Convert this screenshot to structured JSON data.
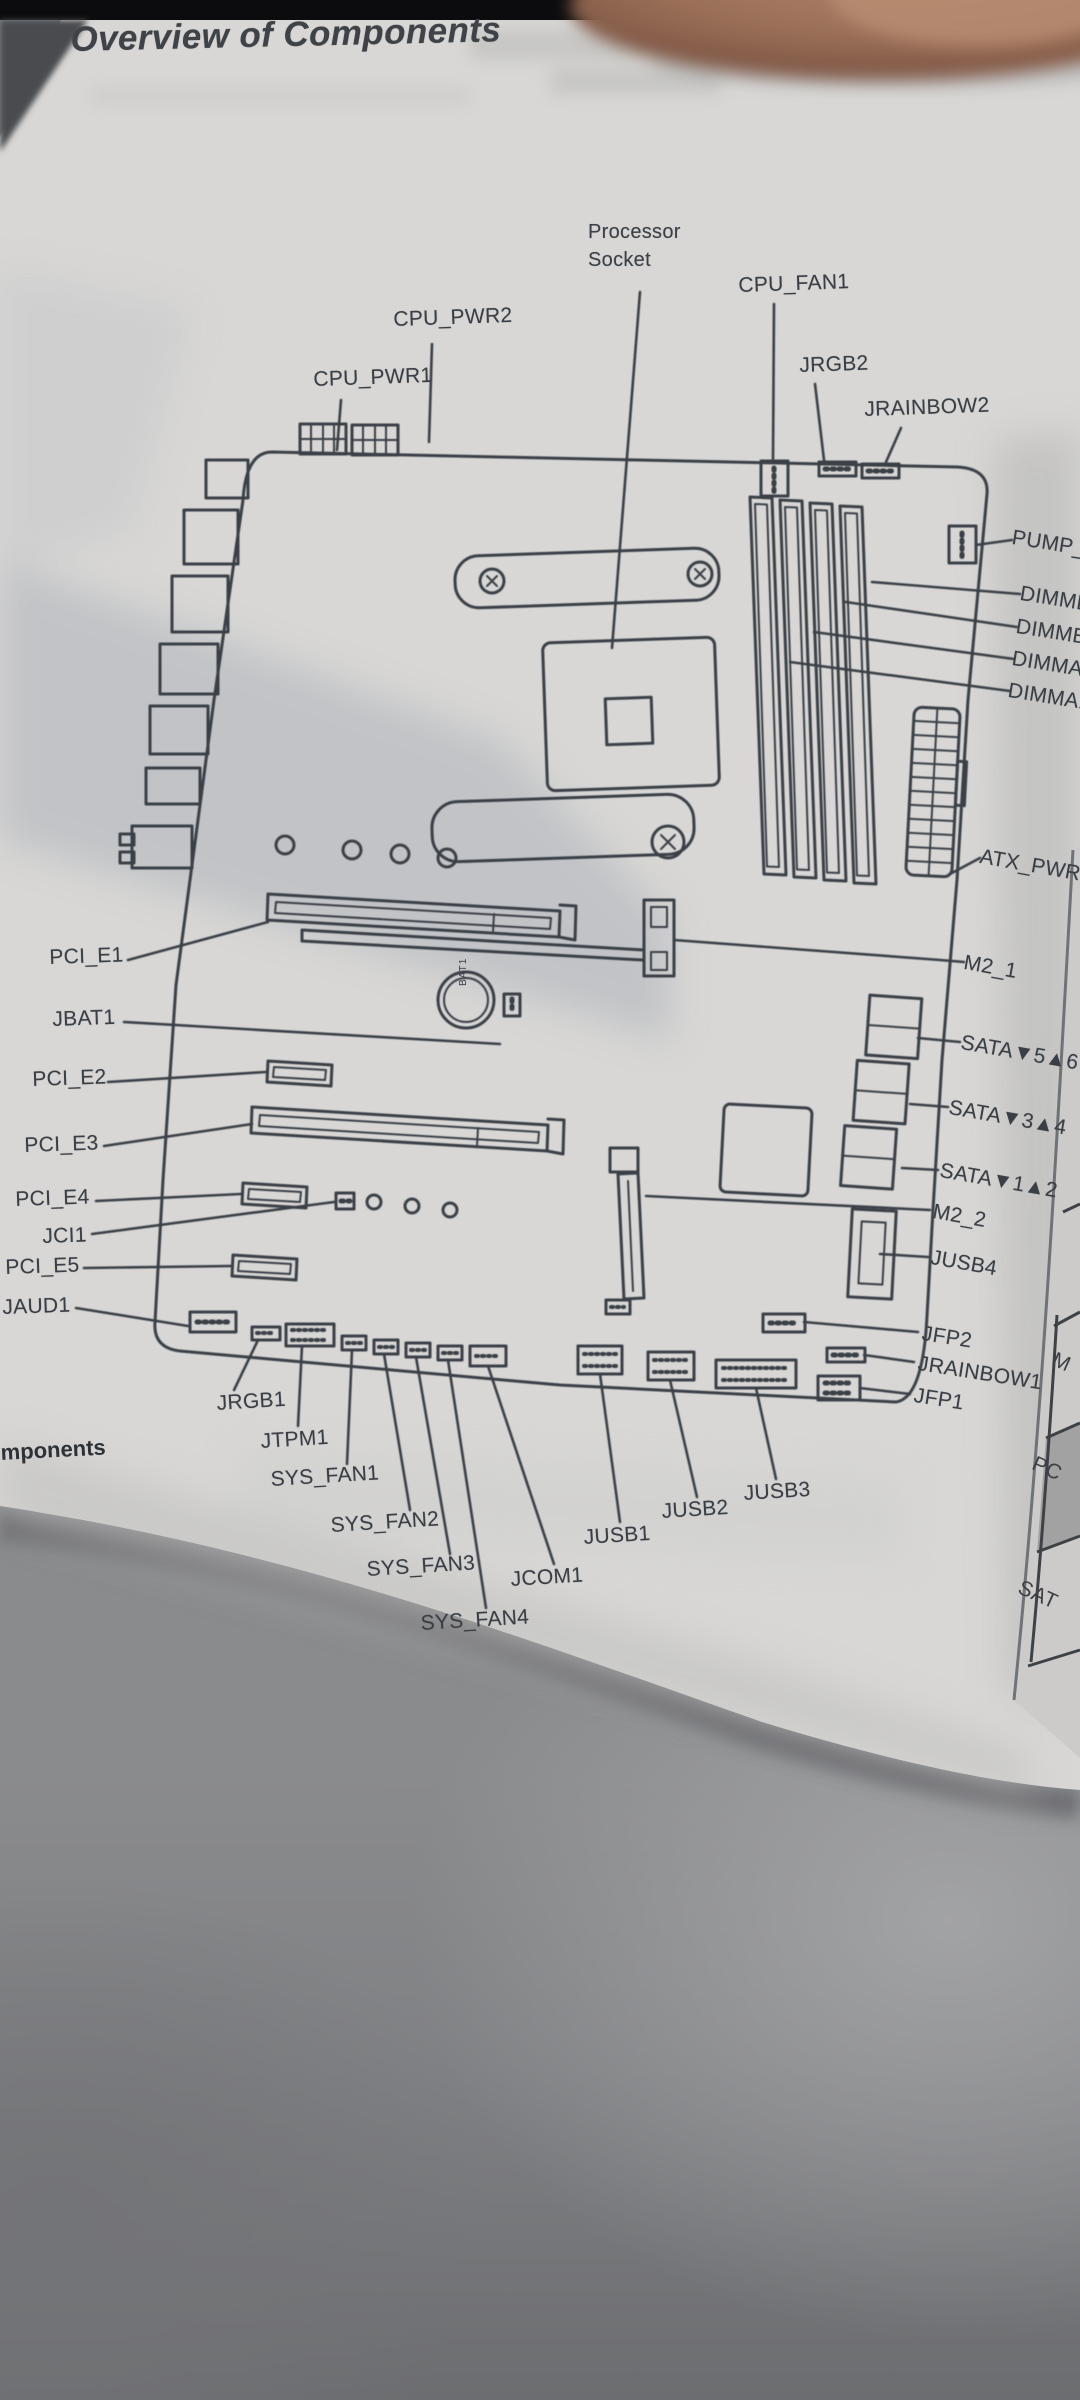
{
  "page": {
    "title": "Overview of Components",
    "footer_partial": "mponents"
  },
  "labels": {
    "processor_socket": "Processor\nSocket",
    "cpu_pwr2": "CPU_PWR2",
    "cpu_pwr1": "CPU_PWR1",
    "cpu_fan1": "CPU_FAN1",
    "jrgb2": "JRGB2",
    "jrainbow2": "JRAINBOW2",
    "pump_fan1": "PUMP_FAN1",
    "dimmb2": "DIMMB2",
    "dimmb1": "DIMMB1",
    "dimma2": "DIMMA2",
    "dimma1": "DIMMA1",
    "atx_pwr1": "ATX_PWR1",
    "m2_1": "M2_1",
    "pci_e1": "PCI_E1",
    "jbat1": "JBAT1",
    "sata56": "SATA▼5▲6",
    "pci_e2": "PCI_E2",
    "sata34": "SATA▼3▲4",
    "pci_e3": "PCI_E3",
    "sata12": "SATA▼1▲2",
    "pci_e4": "PCI_E4",
    "m2_2": "M2_2",
    "jci1": "JCI1",
    "jusb4": "JUSB4",
    "pci_e5": "PCI_E5",
    "jaud1": "JAUD1",
    "jfp2": "JFP2",
    "jrainbow1": "JRAINBOW1",
    "jfp1": "JFP1",
    "jrgb1": "JRGB1",
    "jtpm1": "JTPM1",
    "sys_fan1": "SYS_FAN1",
    "sys_fan2": "SYS_FAN2",
    "sys_fan3": "SYS_FAN3",
    "sys_fan4": "SYS_FAN4",
    "jcom1": "JCOM1",
    "jusb1": "JUSB1",
    "jusb2": "JUSB2",
    "jusb3": "JUSB3",
    "battery": "BAT1"
  },
  "facing_page_table": {
    "row1": "M",
    "row2": "PC",
    "row3": "SAT"
  },
  "colors": {
    "ink": "#3b4046",
    "page": "#d8d7d5",
    "shaded_cell": "#a3a2a2"
  }
}
